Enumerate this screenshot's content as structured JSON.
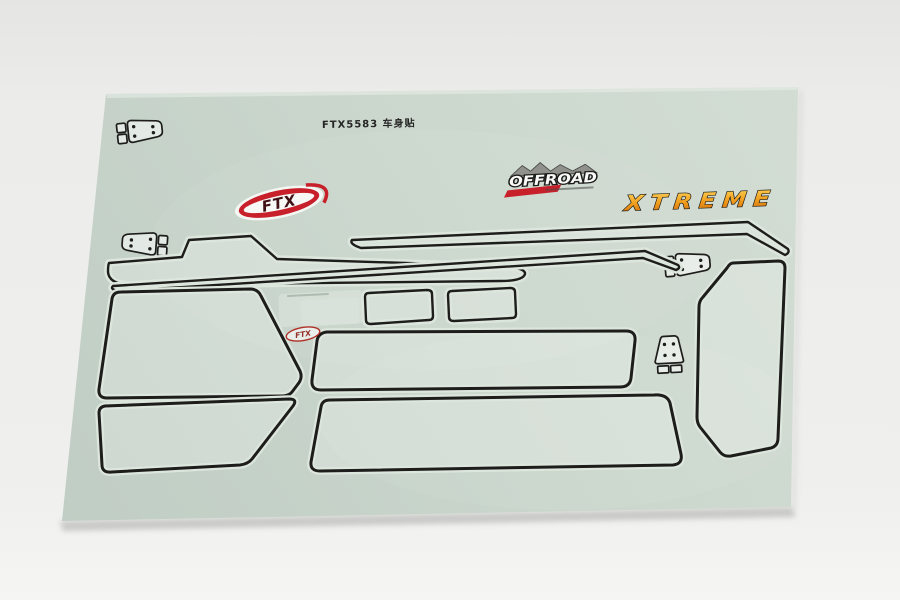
{
  "scene": {
    "type": "product-photo",
    "subject": "RC car bodyshell decal sticker sheet on a white studio backdrop",
    "backdrop_color": "#ededeb"
  },
  "sheet": {
    "part_label": "FTX5583 车身贴",
    "base_color": "#c9d5cb",
    "outline_color": "#1d1d1b"
  },
  "logos": {
    "ftx_main": "FTX",
    "ftx_small": "FTX",
    "offroad": "OFFROAD",
    "graffiti": "XTREME",
    "brand_red": "#c8202a",
    "graffiti_orange": "#f09c1c"
  }
}
